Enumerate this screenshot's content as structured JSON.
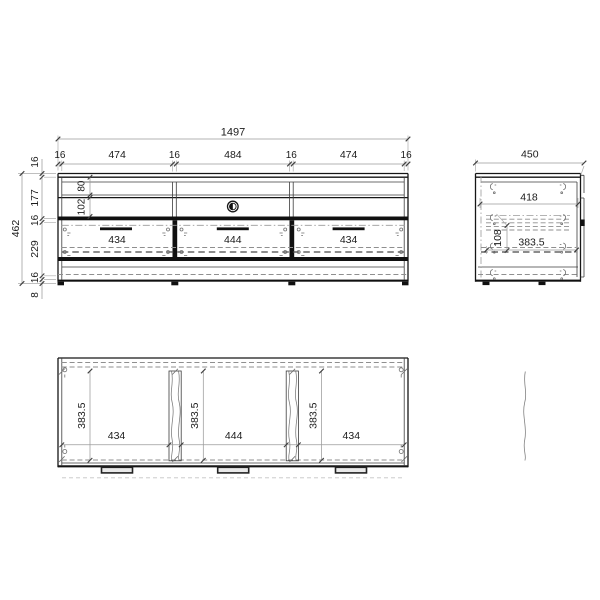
{
  "colors": {
    "background": "#ffffff",
    "line": "#161616",
    "dim_line": "#9a9a9a",
    "text": "#1b1b1b"
  },
  "front_view": {
    "overall_width": "1497",
    "top_chain": [
      "16",
      "474",
      "16",
      "484",
      "16",
      "474",
      "16"
    ],
    "overall_height": "462",
    "left_chain": [
      "16",
      "177",
      "16",
      "229",
      "16",
      "8"
    ],
    "shelf_heights": [
      "80",
      "102"
    ],
    "drawer_widths": [
      "434",
      "444",
      "434"
    ]
  },
  "side_view": {
    "overall_depth": "450",
    "inner_depth": "418",
    "drawer_inner_height": "108",
    "drawer_inner_depth": "383.5"
  },
  "top_view": {
    "compartment_depths": [
      "383.5",
      "383.5",
      "383.5"
    ],
    "compartment_widths": [
      "434",
      "444",
      "434"
    ]
  }
}
